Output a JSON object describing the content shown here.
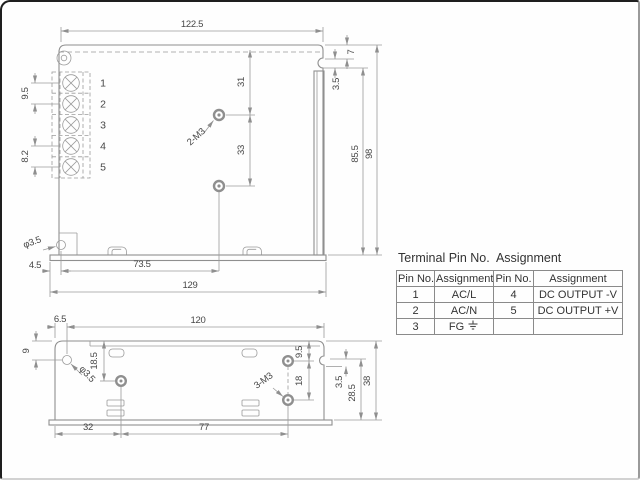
{
  "top_view": {
    "width": "122.5",
    "hole_top": "31",
    "hole_gap": "33",
    "notch_top": "7",
    "notch": "3.5",
    "rail_height": "85.5",
    "height": "98",
    "pin_pitch": "9.5",
    "pin_pitch_last": "8.2",
    "mount_hole": "φ3.5",
    "hole_offset": "4.5",
    "hole_span": "73.5",
    "total_width": "129",
    "screw_label": "2-M3",
    "pins": [
      "1",
      "2",
      "3",
      "4",
      "5"
    ]
  },
  "side_view": {
    "hole_offset": "6.5",
    "width": "120",
    "hole_top": "9",
    "screw_top": "18.5",
    "mount_hole": "φ3.5",
    "right_hole_top": "9.5",
    "right_hole_gap": "18",
    "screw_label": "3-M3",
    "notch": "3.5",
    "notch_to_bottom": "28.5",
    "height": "38",
    "screw_left": "32",
    "screw_span": "77"
  },
  "table": {
    "title": "Terminal Pin No.  Assignment",
    "headers": [
      "Pin No.",
      "Assignment",
      "Pin No.",
      "Assignment"
    ],
    "rows": [
      [
        "1",
        "AC/L",
        "4",
        "DC OUTPUT -V"
      ],
      [
        "2",
        "AC/N",
        "5",
        "DC OUTPUT +V"
      ],
      [
        "3",
        "FG",
        "",
        ""
      ]
    ]
  }
}
